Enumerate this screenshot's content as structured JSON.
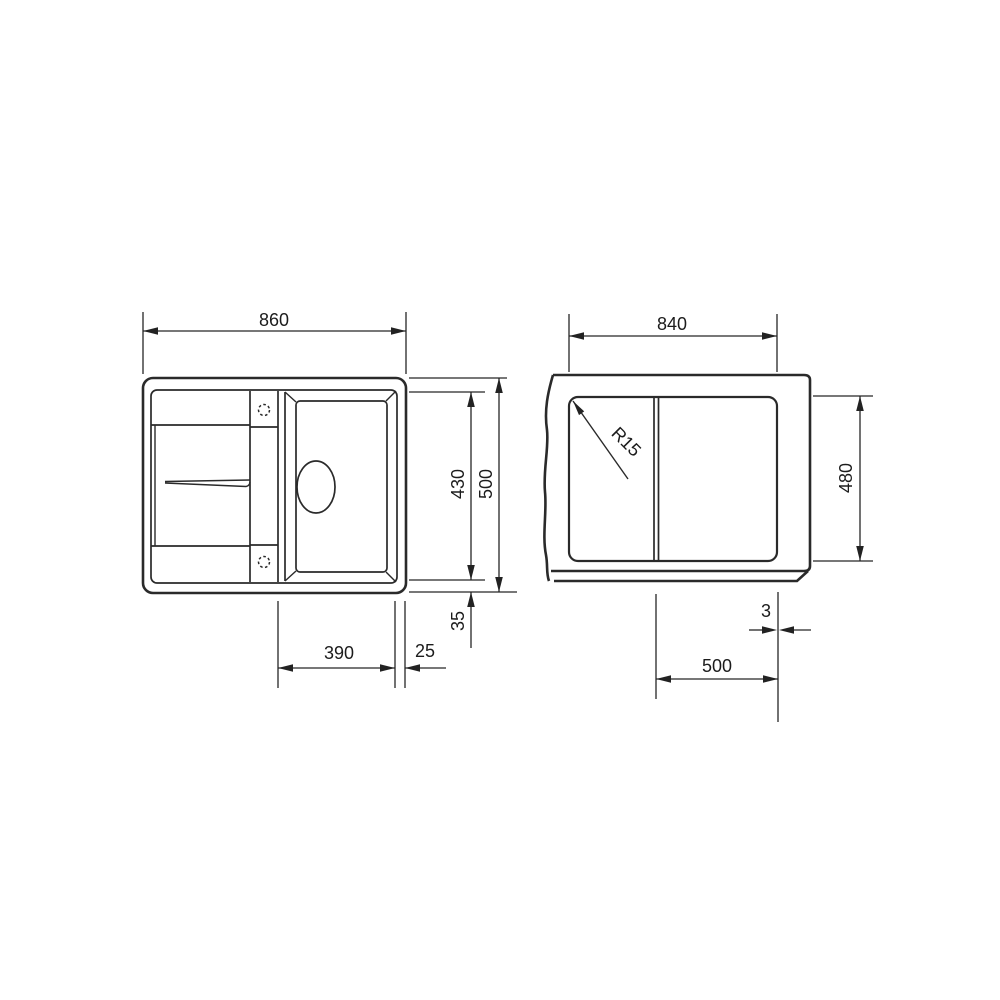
{
  "colors": {
    "background": "#ffffff",
    "line": "#2a2a2a",
    "text": "#1c1c1c"
  },
  "views": {
    "top": {
      "overall_width": "860",
      "overall_depth": "500",
      "inner_depth": "430",
      "bowl_width": "390",
      "bowl_edge_offset": "25",
      "rim_offset": "35"
    },
    "cutout": {
      "width": "840",
      "depth": "480",
      "bowl_offset": "500",
      "edge_gap": "3",
      "corner_radius": "R15"
    }
  }
}
